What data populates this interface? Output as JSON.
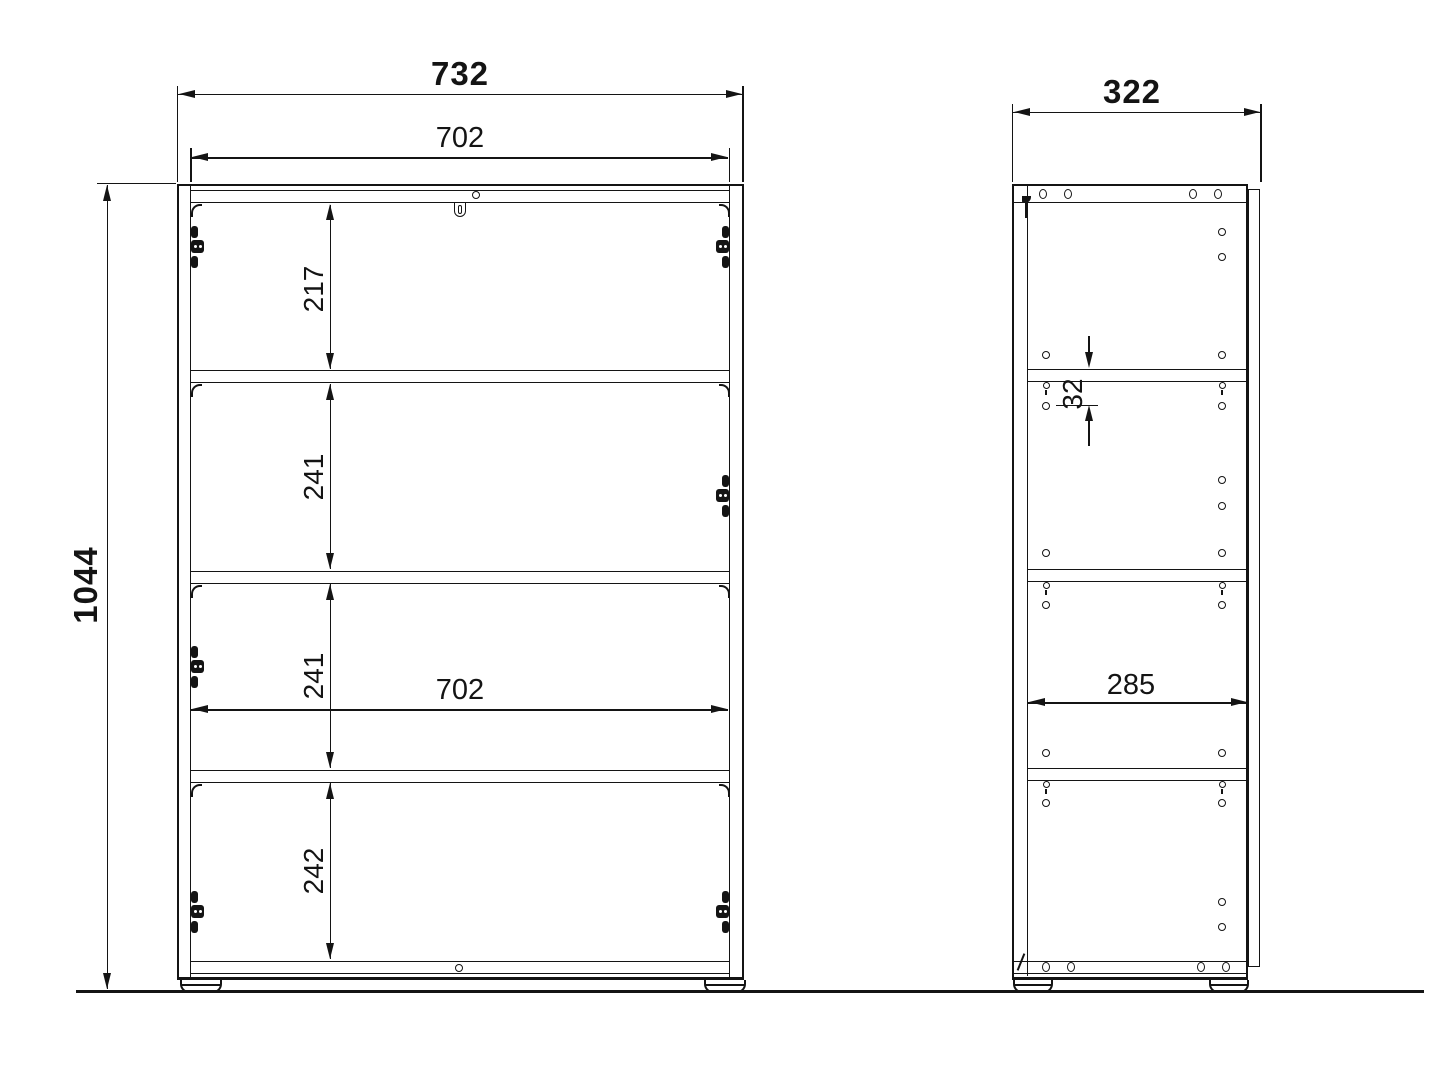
{
  "front_view": {
    "overall_width": "732",
    "inner_width_top": "702",
    "overall_height": "1044",
    "compartment_heights": [
      "217",
      "241",
      "241",
      "242"
    ],
    "inner_width_middle": "702"
  },
  "side_view": {
    "overall_depth": "322",
    "shelf_hole_offset": "32",
    "inner_depth": "285"
  },
  "colors": {
    "line": "#141414",
    "background": "#ffffff"
  }
}
